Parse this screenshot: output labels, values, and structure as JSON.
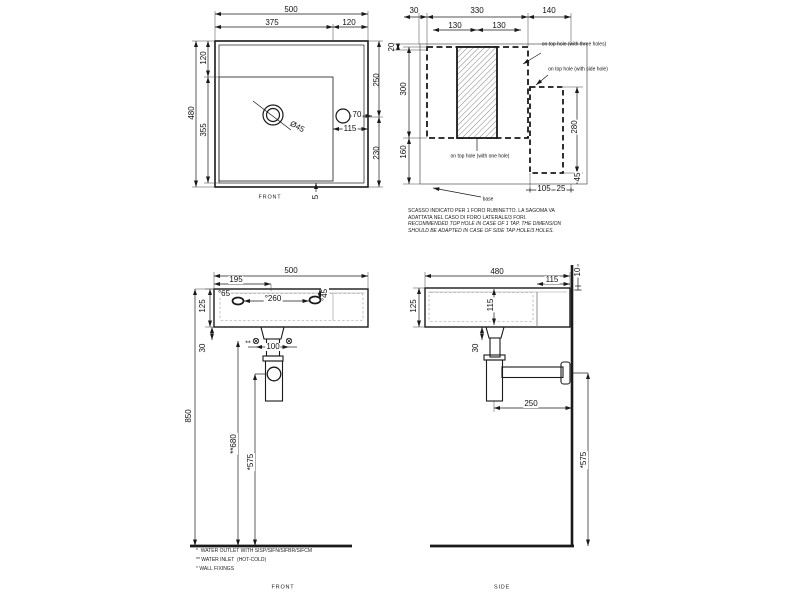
{
  "top": {
    "w500": "500",
    "w375": "375",
    "w120": "120",
    "h120": "120",
    "h355": "355",
    "h480": "480",
    "h250": "250",
    "h230": "230",
    "drain": "Ø45",
    "hole70": "70",
    "d115": "115",
    "gap5": "5",
    "label": "FRONT"
  },
  "holes": {
    "d30": "30",
    "d330": "330",
    "d140": "140",
    "d130a": "130",
    "d130b": "130",
    "d20": "20",
    "d300": "300",
    "d160": "160",
    "d280": "280",
    "d45": "45",
    "d105": "105",
    "d25": "25",
    "three": "on top hole (with three holes)",
    "side": "on top hole (with side hole)",
    "one": "on top hole (with one hole)",
    "base": "base",
    "note1": "SCASSO INDICATO PER 1 FORO RUBINETTO. LA SAGOMA VA",
    "note2": "ADATTATA NEL CASO DI FORO LATERALE/3 FORI.",
    "note3": "RECOMMENDED TOP HOLE IN CASE OF 1 TAP. THE DIMENSION",
    "note4": "SHOULD BE ADAPTED IN CASE OF SIDE TAP HOLE/3 HOLES."
  },
  "front": {
    "w500": "500",
    "w195": "195",
    "f65": "°65",
    "f260": "°260",
    "f45": "°45",
    "h125": "125",
    "h30": "30",
    "h850": "850",
    "stars": "**",
    "w100": "100",
    "h680": "**680",
    "h575": "*575",
    "label": "FRONT",
    "note_outlet": "*  WATER OUTLET WITH SISP/SIFN/SIFBR/SIFCM",
    "note_inlet": "** WATER INLET  (HOT-COLD)",
    "note_fix": "° WALL FIXINGS"
  },
  "side": {
    "d480": "480",
    "d115": "115",
    "d10": "10",
    "h115": "115",
    "h125": "125",
    "h30": "30",
    "d250": "250",
    "h575": "*575",
    "label": "SIDE"
  }
}
